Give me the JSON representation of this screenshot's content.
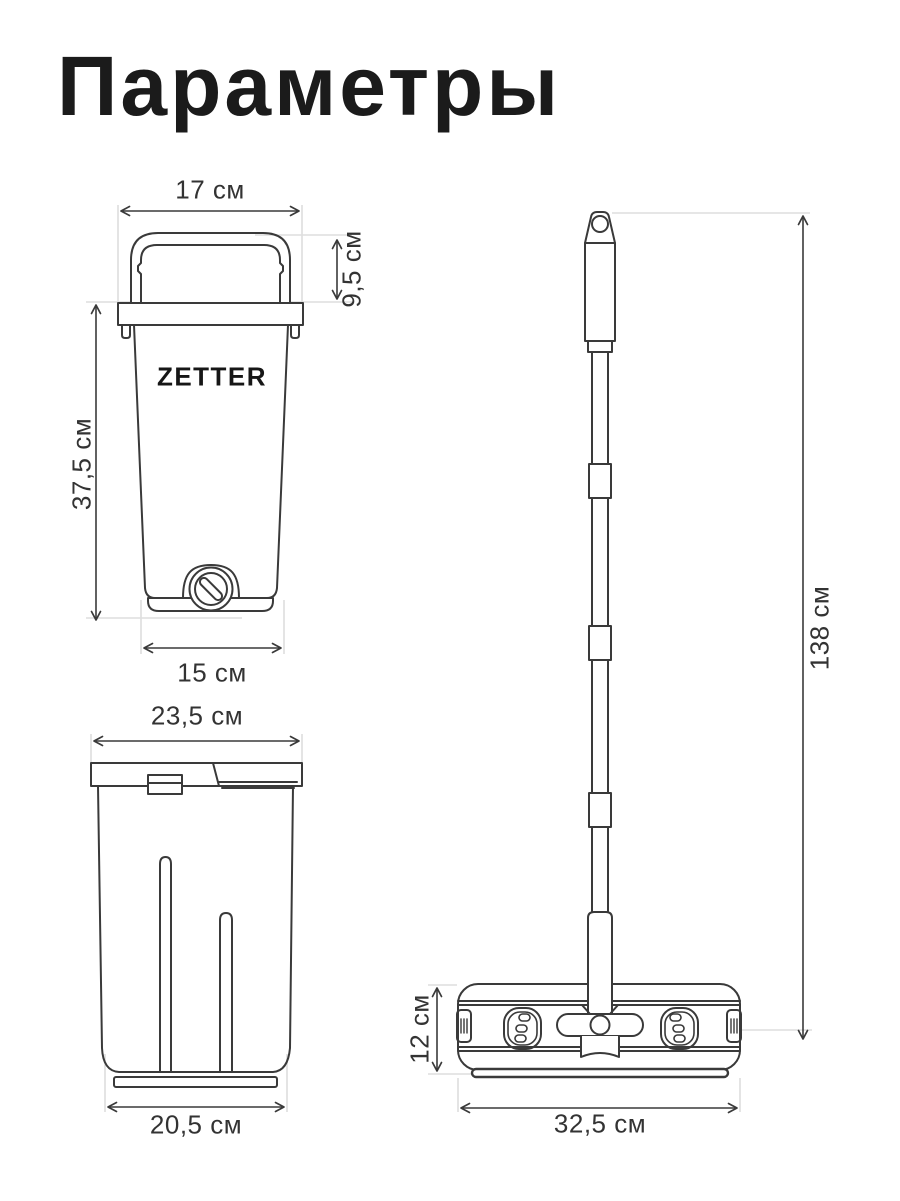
{
  "title": "Параметры",
  "brand_logo": "ZETTER",
  "colors": {
    "line": "#3a3a3a",
    "extension_line": "#dedede",
    "text": "#333333",
    "title": "#1b1b1b"
  },
  "bucket_front_view": {
    "top_width_label": "17 см",
    "handle_height_label": "9,5 см",
    "height_label": "37,5 см",
    "bottom_width_label": "15 см"
  },
  "bucket_side_view": {
    "top_width_label": "23,5 см",
    "bottom_width_label": "20,5 см"
  },
  "mop_view": {
    "total_height_label": "138 см",
    "head_height_label": "12 см",
    "head_width_label": "32,5 см"
  }
}
